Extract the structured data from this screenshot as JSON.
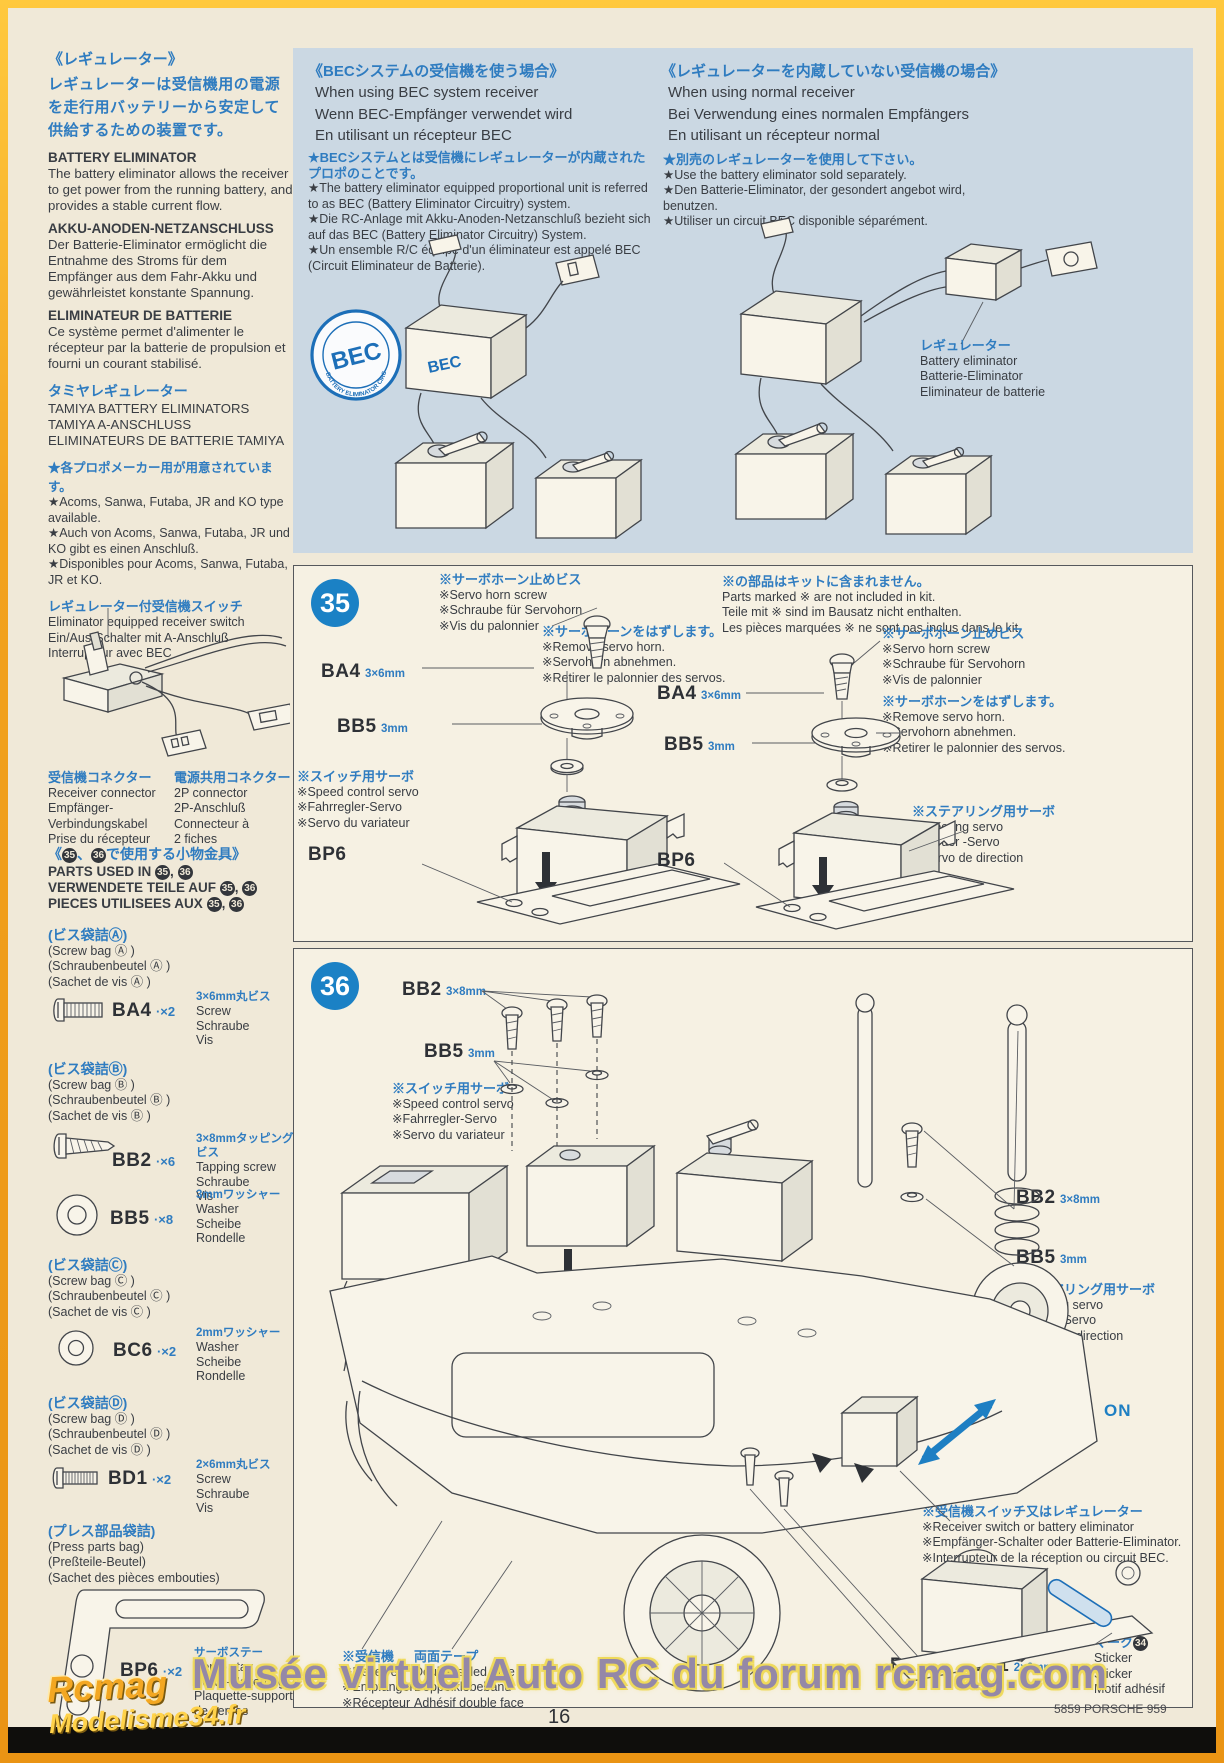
{
  "colors": {
    "accent_blue": "#2f7cc0",
    "panel_blue": "#cbd8e3",
    "step_circle_blue": "#1b81c5",
    "frame_orange": "#f2a21e",
    "paper": "#f0e9d8"
  },
  "page": {
    "number": "16",
    "product_code": "5859 PORSCHE 959",
    "watermark": "Musée virtuel Auto RC du forum rcmag.com",
    "logo_top": "Rcmag",
    "logo_bottom": "Modelisme34.fr"
  },
  "left": {
    "reg_jp_title": "《レギュレーター》",
    "reg_jp_body": "レギュレーターは受信機用の電源を走行用バッテリーから安定して供給するための装置です。",
    "be_title": "BATTERY ELIMINATOR",
    "be_body": "The battery eliminator allows the receiver to get power from the running battery, and provides a stable current flow.",
    "de_title": "AKKU-ANODEN-NETZANSCHLUSS",
    "de_body": "Der Batterie-Eliminator ermöglicht die Entnahme des Stroms für dem Empfänger aus dem Fahr-Akku und gewährleistet konstante Spannung.",
    "fr_title": "ELIMINATEUR DE BATTERIE",
    "fr_body": "Ce système permet d'alimenter le récepteur par la batterie de propulsion et fourni un courant stabilisé.",
    "tam_jp": "タミヤレギュレーター",
    "tam_en": "TAMIYA BATTERY ELIMINATORS",
    "tam_de": "TAMIYA A-ANSCHLUSS",
    "tam_fr": "ELIMINATEURS DE BATTERIE TAMIYA",
    "br_jp": "★各プロポメーカー用が用意されています。",
    "br_en": "★Acoms, Sanwa, Futaba, JR and KO type available.",
    "br_de": "★Auch von Acoms, Sanwa, Futaba, JR und KO gibt es einen Anschluß.",
    "br_fr": "★Disponibles pour Acoms, Sanwa, Futaba, JR et KO.",
    "sw_jp": "レギュレーター付受信機スイッチ",
    "sw_en": "Eliminator equipped receiver switch",
    "sw_de": "Ein/Aus-Schalter mit A-Anschluß",
    "sw_fr": "Interrupteur avec BEC",
    "rc_jp": "受信機コネクター",
    "rc_1": "Receiver connector",
    "rc_2": "Empfänger-",
    "rc_3": "Verbindungskabel",
    "rc_4": "Prise du récepteur",
    "pc_jp": "電源共用コネクター",
    "pc_1": "2P connector",
    "pc_2": "2P-Anschluß",
    "pc_3": "Connecteur à",
    "pc_4": "2 fiches"
  },
  "parts_used": {
    "jp_pre": "《",
    "jp_sep": "、",
    "jp_post": "で使用する小物金具》",
    "en": "PARTS USED IN",
    "de": "VERWENDETE TEILE AUF",
    "fr": "PIECES UTILISEES AUX",
    "sep": ", ",
    "s1": "35",
    "s2": "36"
  },
  "bags": [
    {
      "jp": "(ビス袋詰Ⓐ)",
      "en": "(Screw bag Ⓐ )",
      "de": "(Schraubenbeutel Ⓐ )",
      "fr": "(Sachet de vis Ⓐ )"
    },
    {
      "jp": "(ビス袋詰Ⓑ)",
      "en": "(Screw bag Ⓑ )",
      "de": "(Schraubenbeutel Ⓑ )",
      "fr": "(Sachet de vis Ⓑ )"
    },
    {
      "jp": "(ビス袋詰Ⓒ)",
      "en": "(Screw bag Ⓒ )",
      "de": "(Schraubenbeutel Ⓒ )",
      "fr": "(Sachet de vis Ⓒ )"
    },
    {
      "jp": "(ビス袋詰Ⓓ)",
      "en": "(Screw bag Ⓓ )",
      "de": "(Schraubenbeutel Ⓓ )",
      "fr": "(Sachet de vis Ⓓ )"
    },
    {
      "jp": "(プレス部品袋詰)",
      "en": "(Press parts bag)",
      "de": "(Preßteile-Beutel)",
      "fr": "(Sachet des pièces embouties)"
    }
  ],
  "items": {
    "ba4": {
      "code": "BA4",
      "qty": "·×2",
      "size": "3×6mm丸ビス",
      "n1": "Screw",
      "n2": "Schraube",
      "n3": "Vis"
    },
    "bb2": {
      "code": "BB2",
      "qty": "·×6",
      "size": "3×8mmタッピングビス",
      "n1": "Tapping screw",
      "n2": "Schraube",
      "n3": "Vis"
    },
    "bb5": {
      "code": "BB5",
      "qty": "·×8",
      "size": "3mmワッシャー",
      "n1": "Washer",
      "n2": "Scheibe",
      "n3": "Rondelle"
    },
    "bc6": {
      "code": "BC6",
      "qty": "·×2",
      "size": "2mmワッシャー",
      "n1": "Washer",
      "n2": "Scheibe",
      "n3": "Rondelle"
    },
    "bd1": {
      "code": "BD1",
      "qty": "·×2",
      "size": "2×6mm丸ビス",
      "n1": "Screw",
      "n2": "Schraube",
      "n3": "Vis"
    },
    "bp6": {
      "code": "BP6",
      "qty": "·×2",
      "size": "サーボステー",
      "n1": "Servo stay",
      "n2": "Servo-Halterung",
      "n3": "Plaquette-support de servos"
    }
  },
  "bec": {
    "jp": "《BECシステムの受信機を使う場合》",
    "en": "When using BEC system receiver",
    "de": "Wenn BEC-Empfänger verwendet wird",
    "fr": "En utilisant un récepteur BEC",
    "n_jp": "★BECシステムとは受信機にレギュレーターが内蔵されたプロポのことです。",
    "n_en": "★The battery eliminator equipped proportional unit is referred to as BEC (Battery Eliminator Circuitry) system.",
    "n_de": "★Die RC-Anlage mit Akku-Anoden-Netzanschluß bezieht sich auf das BEC (Battery Eliminator Circuitry) System.",
    "n_fr": "★Un ensemble R/C équipé d'un éliminateur est appelé BEC (Circuit Eliminateur de Batterie).",
    "stamp": "BEC",
    "stamp_arc": "BATTERY ELIMINATOR CIRCUITRY",
    "tag": "BEC"
  },
  "normal": {
    "jp": "《レギュレーターを内蔵していない受信機の場合》",
    "en": "When using normal receiver",
    "de": "Bei Verwendung eines normalen Empfängers",
    "fr": "En utilisant un récepteur normal",
    "n_jp": "★別売のレギュレーターを使用して下さい。",
    "n_en": "★Use the battery eliminator sold separately.",
    "n_de": "★Den Batterie-Eliminator, der gesondert angebot wird, benutzen.",
    "n_fr": "★Utiliser un circuit BEC disponible séparément.",
    "el_jp": "レギュレーター",
    "el_en": "Battery eliminator",
    "el_de": "Batterie-Eliminator",
    "el_fr": "Eliminateur de batterie"
  },
  "s35": {
    "num": "35",
    "kit_jp": "※の部品はキットに含まれません。",
    "kit_en": "Parts marked ※ are not included in kit.",
    "kit_de": "Teile mit ※ sind im Bausatz nicht enthalten.",
    "kit_fr": "Les pièces marquées ※ ne sont pas inclus dans le kit.",
    "hs_jp": "※サーボホーン止めビス",
    "hs_en": "※Servo horn screw",
    "hs_de": "※Schraube für Servohorn",
    "hs_fr_l": "※Vis du palonnier",
    "hs_fr_r": "※Vis de palonnier",
    "rh_jp": "※サーボホーンをはずします。",
    "rh_en": "※Remove servo horn.",
    "rh_de": "※Servohorn abnehmen.",
    "rh_fr": "※Retirer le palonnier des servos.",
    "sp_jp": "※スイッチ用サーボ",
    "sp_en": "※Speed control servo",
    "sp_de": "※Fahrregler-Servo",
    "sp_fr": "※Servo du variateur",
    "st_jp": "※ステアリング用サーボ",
    "st_en": "※Steering servo",
    "st_de": "※Steuer -Servo",
    "st_fr": "※Servo de direction",
    "ba4": "BA4",
    "ba4_s": "3×6mm",
    "bb5": "BB5",
    "bb5_s": "3mm",
    "bp6": "BP6"
  },
  "s36": {
    "num": "36",
    "bb2": "BB2",
    "bb2_s": "3×8mm",
    "bb5": "BB5",
    "bb5_s": "3mm",
    "sp_jp": "※スイッチ用サーボ",
    "sp_en": "※Speed control servo",
    "sp_de": "※Fahrregler-Servo",
    "sp_fr": "※Servo du variateur",
    "st_jp": "※ステアリング用サーボ",
    "st_en": "※Steering servo",
    "st_de": "※Steuer-Servo",
    "st_fr": "※Servo de direction",
    "on": "ON",
    "off": "OFF",
    "sn_jp": "※受信機スイッチ又はレギュレーター",
    "sn_en": "※Receiver switch or battery eliminator",
    "sn_de": "※Empfänger-Schalter oder Batterie-Eliminator.",
    "sn_fr": "※Interrupteur de la réception ou circuit BEC.",
    "rx_jp": "※受信機",
    "rx_en": "※Receiver",
    "rx_de": "※Empfänger",
    "rx_fr": "※Récepteur",
    "tp_jp": "両面テープ",
    "tp_en": "Double sided tape",
    "tp_de": "Doppelklebeband",
    "tp_fr": "Adhésif double face",
    "bc6": "BC6",
    "bc6_s": "2mm",
    "bd1": "BD1",
    "bd1_s": "2×6mm",
    "mk_jp": "マーク",
    "mk_num": "34",
    "mk_1": "Sticker",
    "mk_2": "Sticker",
    "mk_3": "Motif adhésif"
  }
}
